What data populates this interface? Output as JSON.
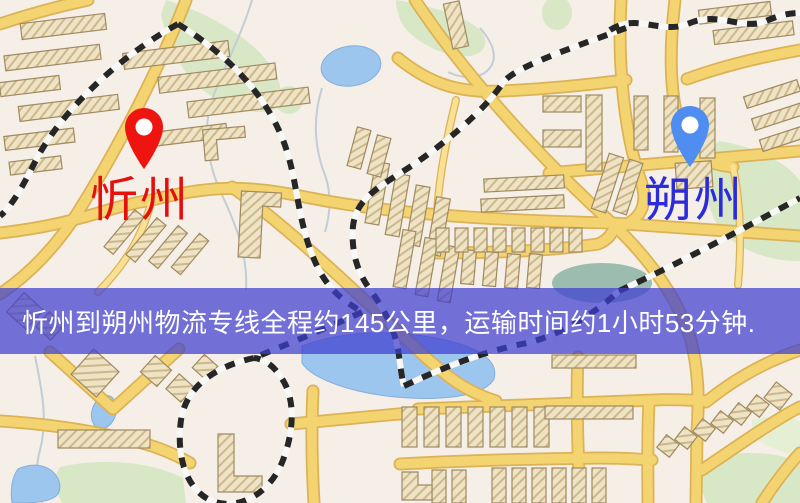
{
  "banner": {
    "text": "忻州到朔州物流专线全程约145公里，运输时间约1小时53分钟.",
    "background_color": "rgba(62,62,208,0.72)",
    "text_color": "#ffffff"
  },
  "markers": {
    "origin": {
      "label": "忻州",
      "pin_color": "#ee1511",
      "label_color": "#e5100e"
    },
    "destination": {
      "label": "朔州",
      "pin_color": "#4f8df0",
      "label_color": "#2b2bdc"
    }
  },
  "route": {
    "origin": "忻州",
    "destination": "朔州",
    "distance_text": "约145公里",
    "duration_text": "约1小时53分钟"
  },
  "palette": {
    "map_background": "#f6efe7",
    "road_fill": "#f4d471",
    "road_casing": "#dcb257",
    "building_fill": "#eee3c4",
    "building_outline": "#9f8a62",
    "park": "#d8e8c6",
    "water": "#9dc6ee",
    "railway": "#262626"
  }
}
